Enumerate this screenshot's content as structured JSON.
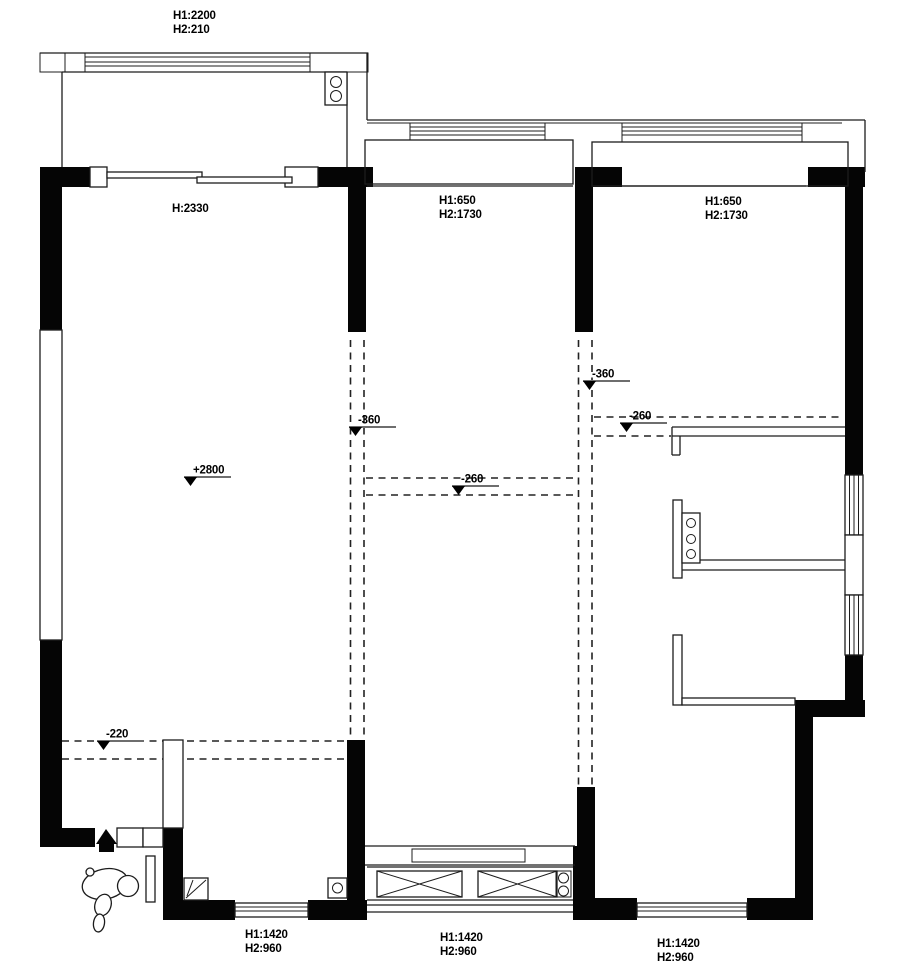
{
  "title": "apartment-ceiling-floor-plan",
  "colors": {
    "wall": "#050505",
    "line": "#1c1c1c",
    "marker_line": "#6e6e6e",
    "background": "#ffffff"
  },
  "labels": {
    "balcony_top_window": {
      "line1": "H1:2200",
      "line2": "H2:210"
    },
    "balcony_door": {
      "line1": "H:2330"
    },
    "mid_bay_window": {
      "line1": "H1:650",
      "line2": "H2:1730"
    },
    "right_bay_window": {
      "line1": "H1:650",
      "line2": "H2:1730"
    },
    "bottom_left_window": {
      "line1": "H1:1420",
      "line2": "H2:960"
    },
    "bottom_mid_window": {
      "line1": "H1:1420",
      "line2": "H2:960"
    },
    "bottom_right_window": {
      "line1": "H1:1420",
      "line2": "H2:960"
    }
  },
  "level_markers": [
    {
      "value": "+2800",
      "x": 184,
      "y": 477
    },
    {
      "value": "-360",
      "x": 349,
      "y": 427
    },
    {
      "value": "-360",
      "x": 583,
      "y": 381
    },
    {
      "value": "-260",
      "x": 452,
      "y": 486
    },
    {
      "value": "-260",
      "x": 620,
      "y": 423
    },
    {
      "value": "-220",
      "x": 97,
      "y": 741
    }
  ]
}
